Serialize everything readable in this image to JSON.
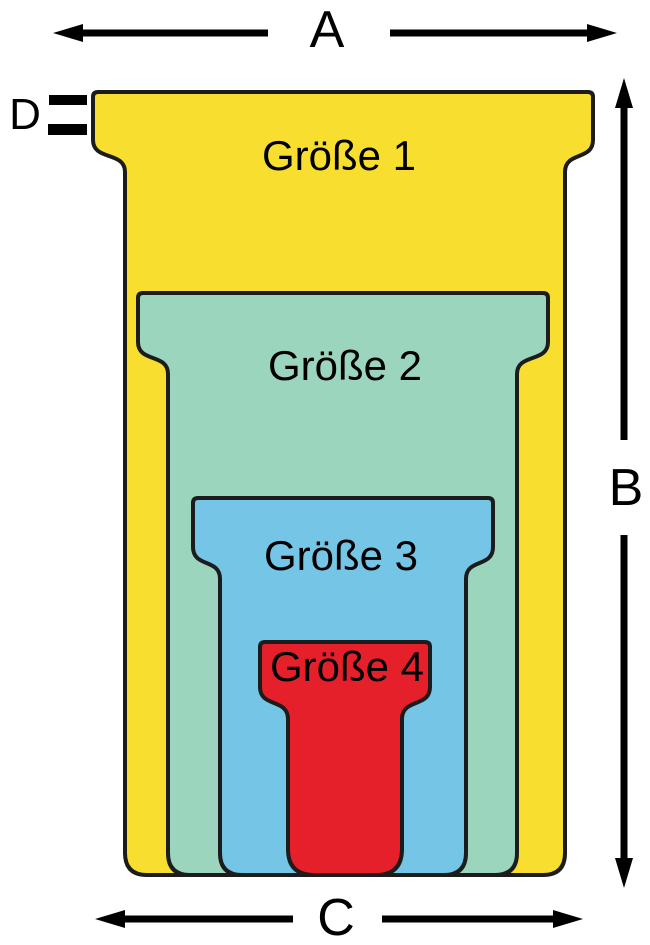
{
  "diagram": {
    "title": "T-card sizes diagram",
    "cards": [
      {
        "id": "groesse-1",
        "label": "Größe 1",
        "color": "#F7DE2F"
      },
      {
        "id": "groesse-2",
        "label": "Größe 2",
        "color": "#9CD5BE"
      },
      {
        "id": "groesse-3",
        "label": "Größe 3",
        "color": "#75C5E6"
      },
      {
        "id": "groesse-4",
        "label": "Größe 4",
        "color": "#E6202A"
      }
    ],
    "dimensions": {
      "width_top": "A",
      "height": "B",
      "width_bottom": "C",
      "tab_lip": "D"
    },
    "outline_color": "#1c1c1c",
    "arrow_color": "#000000",
    "background_color": "#ffffff"
  }
}
